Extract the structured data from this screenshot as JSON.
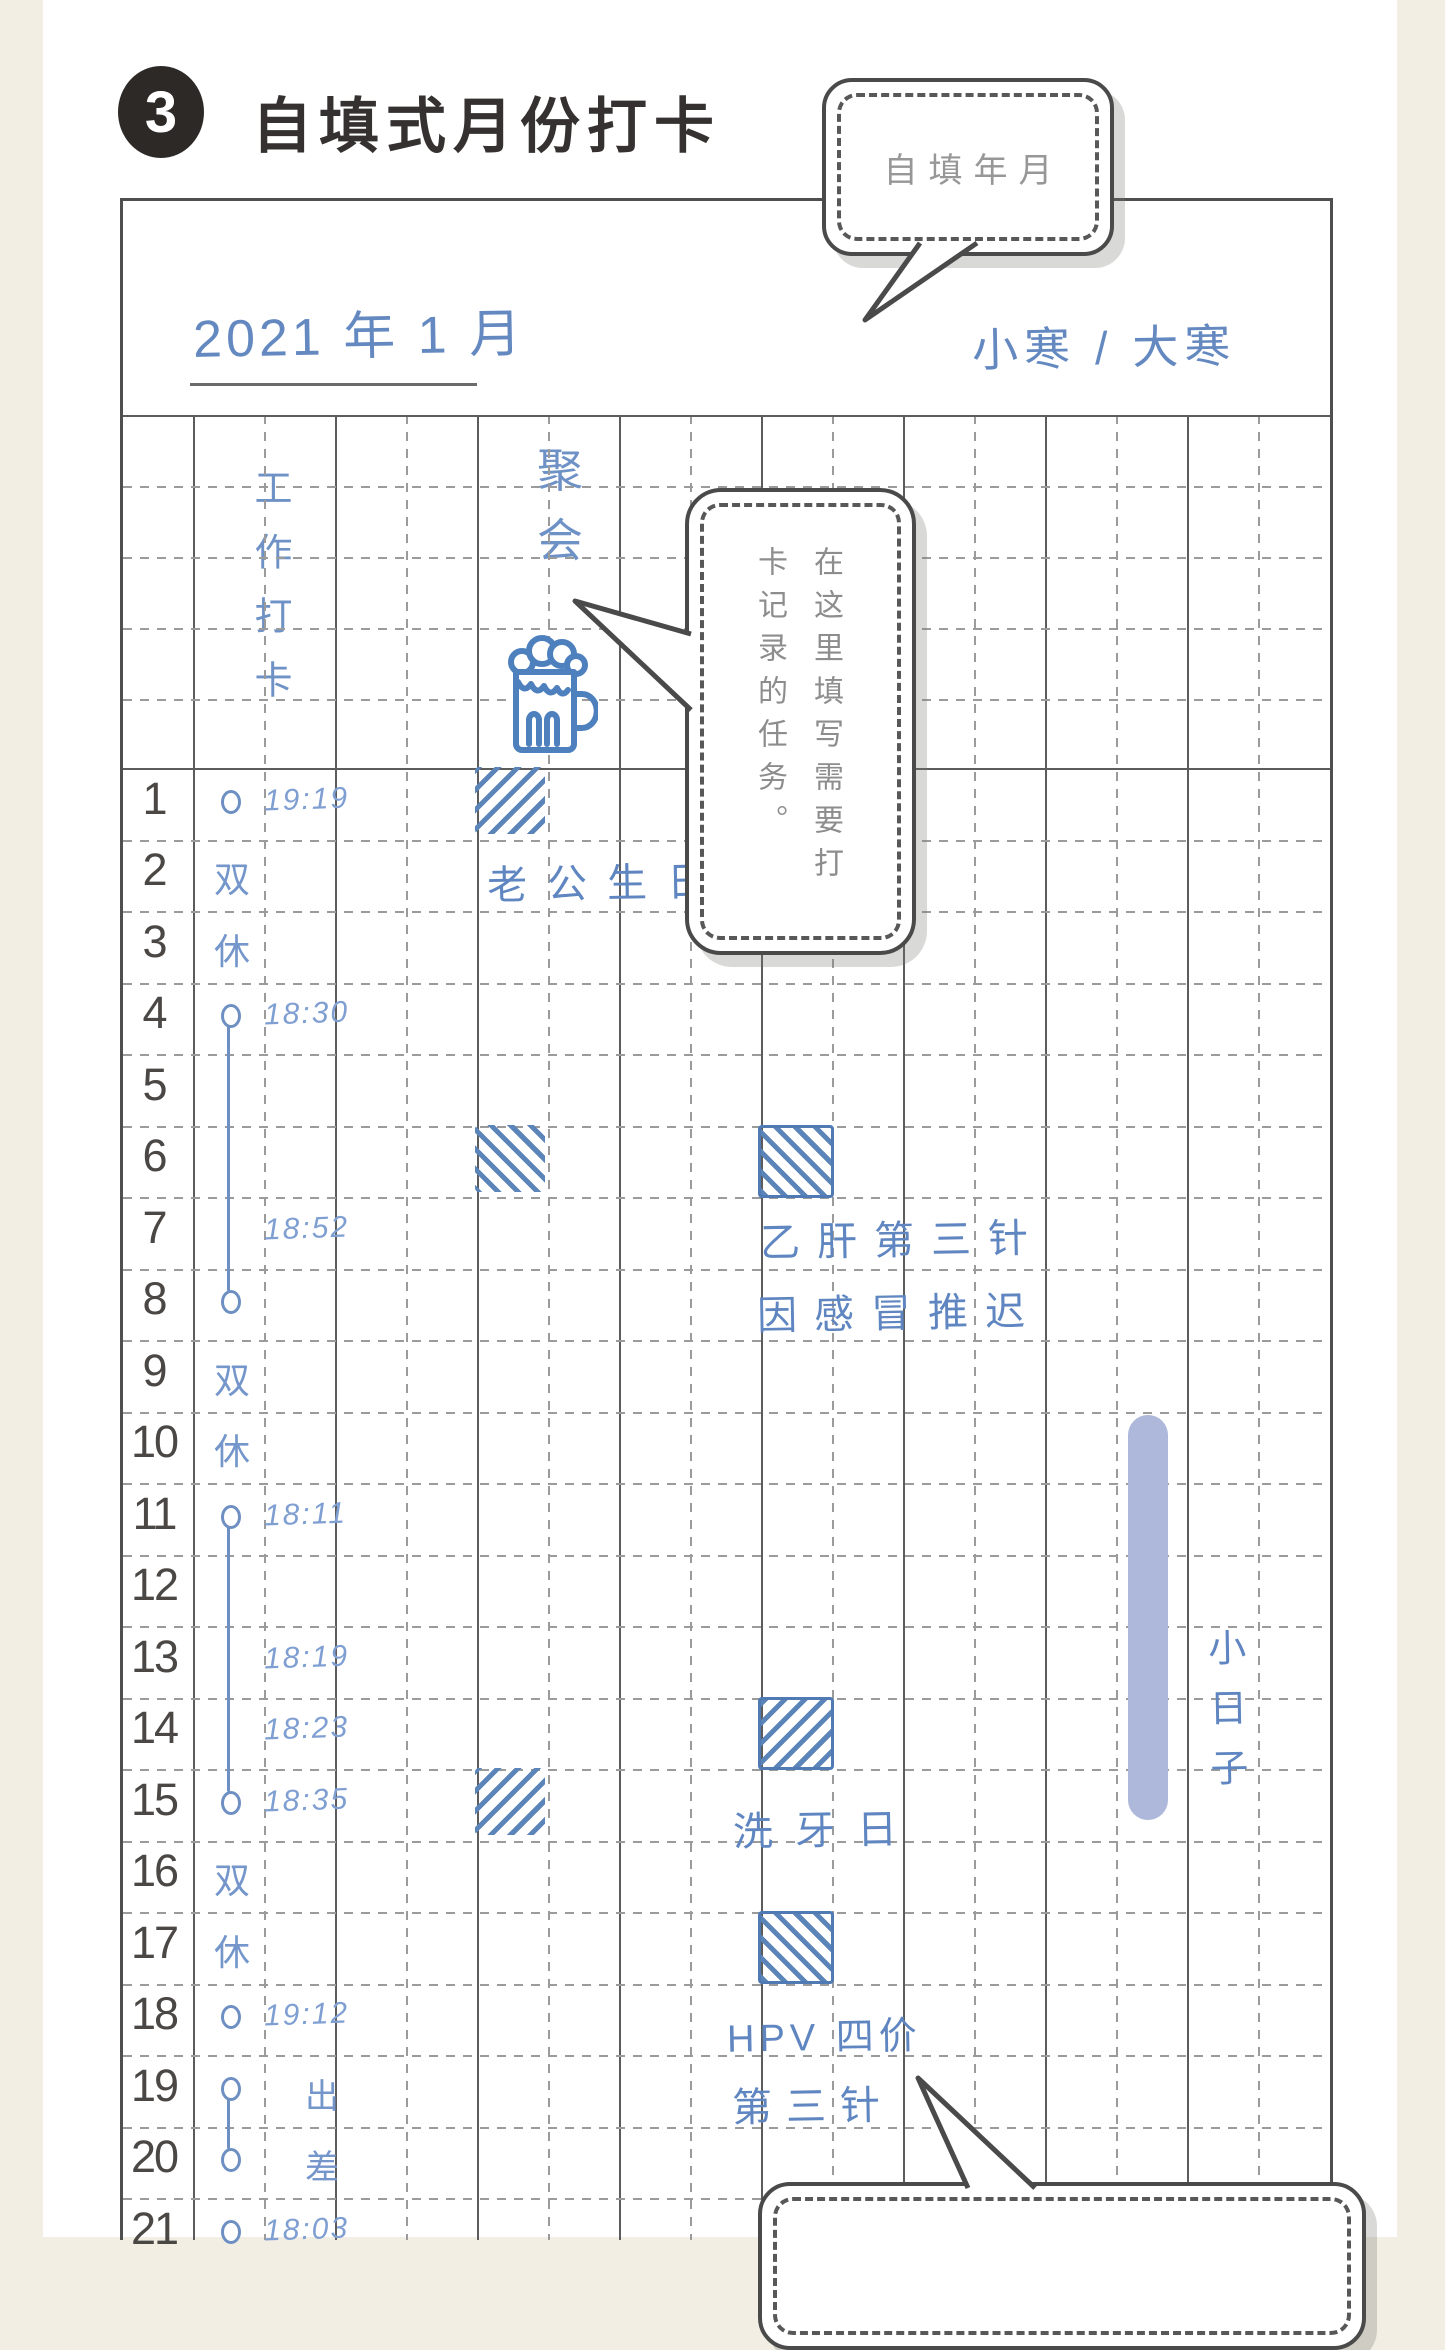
{
  "section": {
    "number": "3",
    "title": "自填式月份打卡"
  },
  "callouts": {
    "fill_year_month": "自填年月",
    "tasks_hint": "在这里填写需要打卡记录的任务。"
  },
  "header": {
    "month_label": "2021 年 1 月",
    "solar_terms": "小寒 / 大寒",
    "column_work": "工作打卡",
    "column_party": "聚会",
    "party_icon": "beer-mug-icon"
  },
  "grid": {
    "days": [
      {
        "day": "1",
        "time": "19:19",
        "circle": true
      },
      {
        "day": "2",
        "note": "双"
      },
      {
        "day": "3",
        "note": "休"
      },
      {
        "day": "4",
        "time": "18:30",
        "circle": true
      },
      {
        "day": "5"
      },
      {
        "day": "6"
      },
      {
        "day": "7",
        "time": "18:52"
      },
      {
        "day": "8",
        "circle": true
      },
      {
        "day": "9",
        "note": "双"
      },
      {
        "day": "10",
        "note": "休"
      },
      {
        "day": "11",
        "time": "18:11",
        "circle": true
      },
      {
        "day": "12"
      },
      {
        "day": "13",
        "time": "18:19"
      },
      {
        "day": "14",
        "time": "18:23"
      },
      {
        "day": "15",
        "time": "18:35",
        "circle": true
      },
      {
        "day": "16",
        "note": "双"
      },
      {
        "day": "17",
        "note": "休"
      },
      {
        "day": "18",
        "time": "19:12",
        "circle": true
      },
      {
        "day": "19",
        "circle": true,
        "note2": "出"
      },
      {
        "day": "20",
        "circle": true,
        "note2": "差"
      },
      {
        "day": "21",
        "time": "18:03",
        "circle": true
      }
    ],
    "connectors": [
      {
        "from": 4,
        "to": 8
      },
      {
        "from": 11,
        "to": 15
      },
      {
        "from": 19,
        "to": 20
      }
    ],
    "marks": [
      {
        "day": 1,
        "column": "party",
        "slant": "back"
      },
      {
        "day": 6,
        "column": "party",
        "slant": "fwd"
      },
      {
        "day": 6,
        "column": "task",
        "slant": "fwd",
        "border": true
      },
      {
        "day": 14,
        "column": "task",
        "slant": "back",
        "border": true
      },
      {
        "day": 15,
        "column": "party",
        "slant": "back"
      },
      {
        "day": 17,
        "column": "task",
        "slant": "fwd",
        "border": true
      }
    ],
    "annotations": [
      {
        "id": "husband_birthday",
        "text": "老公生日"
      },
      {
        "id": "hepb_1",
        "text": "乙肝第三针"
      },
      {
        "id": "hepb_2",
        "text": "因感冒推迟"
      },
      {
        "id": "teeth",
        "text": "洗牙日"
      },
      {
        "id": "hpv_1",
        "text": "HPV 四价"
      },
      {
        "id": "hpv_2",
        "text": "第三针"
      },
      {
        "id": "little_days",
        "text": "小日子"
      }
    ]
  },
  "colors": {
    "paper": "#f2eee4",
    "ink_blue": "#6488c0",
    "hatch_blue": "#5b84b8",
    "highlight_bar": "#adb8da",
    "grid_line": "#5c5c5c",
    "bubble_border": "#4a4a4a"
  }
}
